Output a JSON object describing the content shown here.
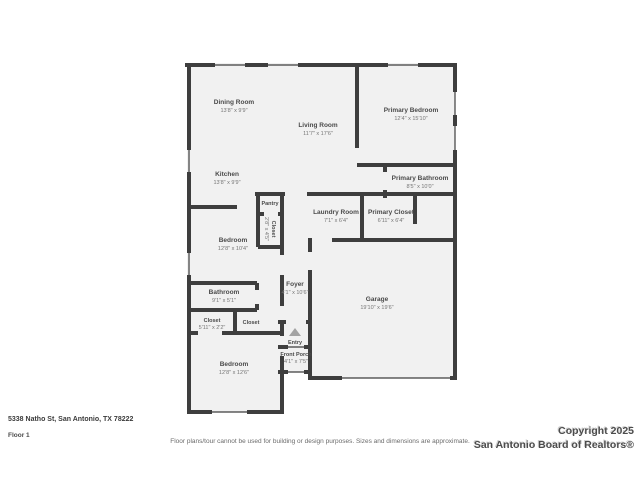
{
  "plan": {
    "wall_color": "#3e3e3e",
    "floor_color": "#f1f1f1",
    "rooms": [
      {
        "name": "Dining Room",
        "dims": "13'8\" x 9'9\""
      },
      {
        "name": "Living Room",
        "dims": "11'7\" x 17'6\""
      },
      {
        "name": "Primary Bedroom",
        "dims": "12'4\" x 15'10\""
      },
      {
        "name": "Kitchen",
        "dims": "13'8\" x 9'9\""
      },
      {
        "name": "Primary Bathroom",
        "dims": "8'5\" x 10'0\""
      },
      {
        "name": "Pantry",
        "dims": ""
      },
      {
        "name": "Closet",
        "dims": "2'8\" x 4'5\""
      },
      {
        "name": "Laundry Room",
        "dims": "7'1\" x 6'4\""
      },
      {
        "name": "Primary Closet",
        "dims": "6'11\" x 6'4\""
      },
      {
        "name": "Bedroom",
        "dims": "12'8\" x 10'4\""
      },
      {
        "name": "Foyer",
        "dims": "4'1\" x 10'6\""
      },
      {
        "name": "Bathroom",
        "dims": "9'1\" x 5'1\""
      },
      {
        "name": "Closet",
        "dims": "5'11\" x 2'2\""
      },
      {
        "name": "Closet",
        "dims": ""
      },
      {
        "name": "Bedroom",
        "dims": "12'8\" x 12'6\""
      },
      {
        "name": "Garage",
        "dims": "19'10\" x 19'6\""
      },
      {
        "name": "Entry",
        "dims": ""
      },
      {
        "name": "Front Porch",
        "dims": "4'1\" x 7'5\""
      }
    ],
    "entry_icon": "stairs-up-arrow"
  },
  "footer": {
    "address": "5338 Natho St, San Antonio, TX 78222",
    "floor_label": "Floor 1",
    "disclaimer": "Floor plans/tour cannot be used for building or design purposes. Sizes and dimensions are approximate.",
    "copyright_line1": "Copyright 2025",
    "copyright_line2": "San Antonio Board of Realtors®"
  }
}
